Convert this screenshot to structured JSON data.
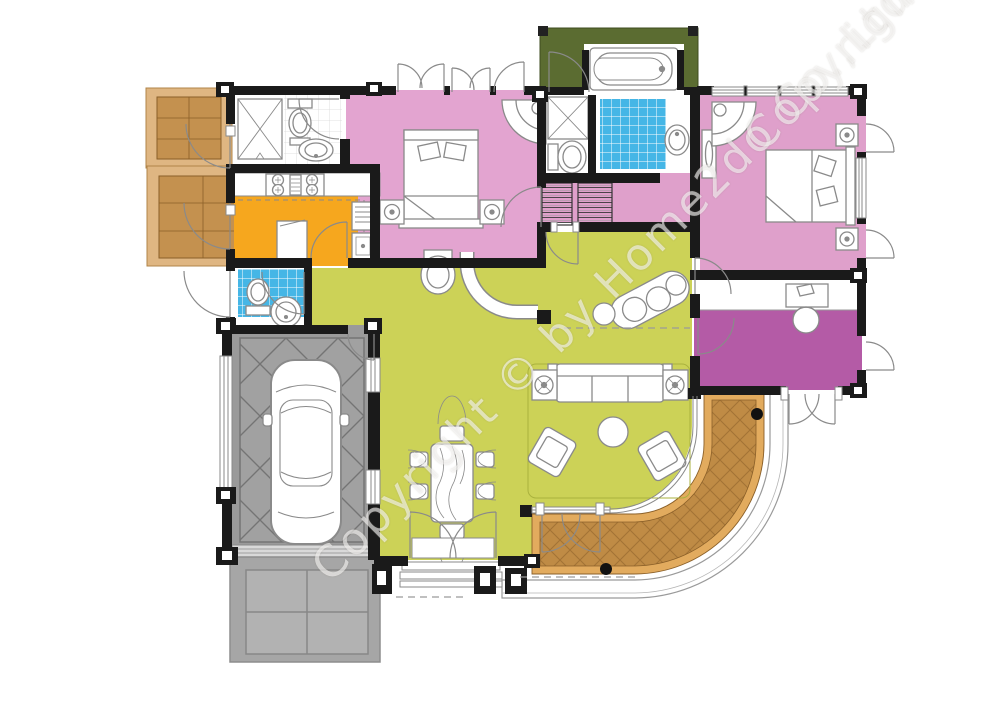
{
  "watermark": {
    "text": "Copyright © by Home2do Co.,Ltd."
  },
  "colors": {
    "wall": "#1a1a1a",
    "bedroom_pink": "#e3a4d0",
    "master_pink": "#dfa0cb",
    "study_magenta": "#b45ba6",
    "living_green": "#ccd257",
    "planter_green": "#5b6c31",
    "kitchen_orange": "#f6a71e",
    "bath_blue": "#45b6e6",
    "deck_border": "#e2ab5e",
    "deck_fill": "#bf8b45",
    "west_deck_frame": "#dfb682",
    "west_deck_fill": "#c4914f",
    "garage_gray": "#9a9a9a",
    "garage_inner": "#a1a1a1",
    "driveway_gray": "#a6a6a6",
    "driveway_tile": "#b2b2b2",
    "fixture_outline": "#8a8a8a",
    "paper_white": "#ffffff"
  },
  "symbols": [
    "car",
    "double-bed",
    "sofa",
    "armchair",
    "dining-table",
    "toilet",
    "bathtub",
    "corner-shower",
    "washbasin",
    "kitchen-stove",
    "refrigerator",
    "kitchen-island",
    "wardrobe",
    "desk-with-computer",
    "chaise-longue",
    "table-lamp",
    "coffee-table"
  ]
}
